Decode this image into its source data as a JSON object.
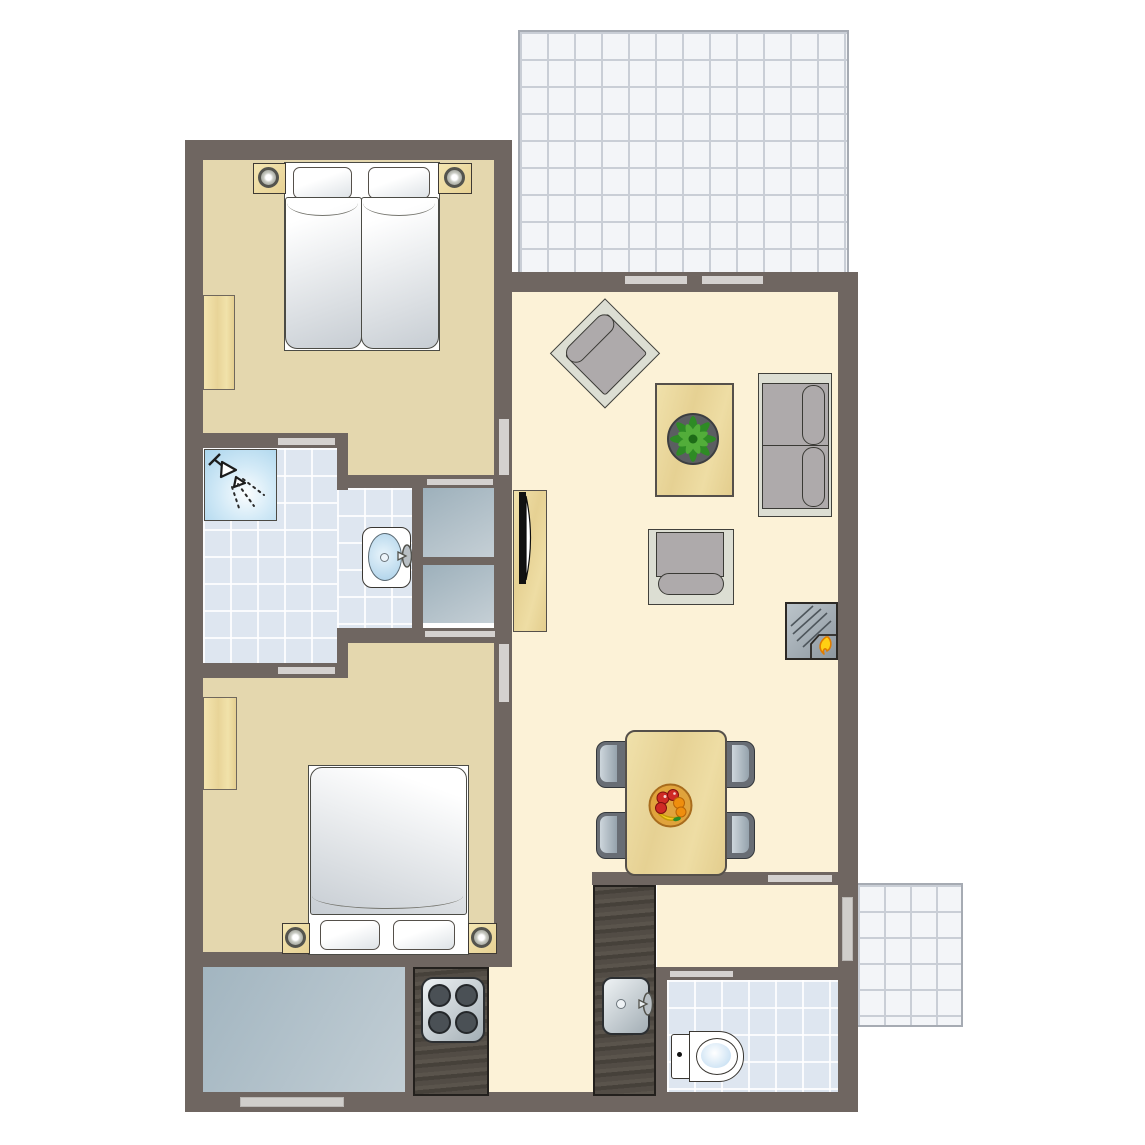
{
  "title": "Apartment floor plan",
  "canvas": {
    "width": 1145,
    "height": 1145
  },
  "palette": {
    "outside": "#ffffff",
    "wall": "#6f6661",
    "door": "#d4d1cf",
    "window": "#d0cecb",
    "bedroom_floor": "#e4d7ae",
    "living_floor": "#fcf2d7",
    "bath_tile": "#dee6f0",
    "terrace_tile": "#f3f5f8",
    "terrace_line": "#c9ced6",
    "terrace_border": "#a6abb3",
    "wood_edge": "#55504a",
    "counter_edge": "#23201d",
    "outline": "#4b4b45",
    "matt_hi": "#ffffff",
    "matt_lo": "#c7cdd3",
    "sofa_base": "#dcded3",
    "cushion": "#aeaaab",
    "chair_dark": "#686d74",
    "chair_edge": "#33373b",
    "seat_hi": "#cdd6dc",
    "seat_lo": "#95a2ac",
    "closet_hi": "#c6d0d6",
    "closet_lo": "#9db0bb",
    "storage_hi": "#c2ced5",
    "storage_lo": "#a2b5c0",
    "shower_hi": "#fbfdfe",
    "shower_lo": "#a9d4ec",
    "basin_hi": "#e8f4fb",
    "basin_lo": "#a8cfe8",
    "appl_hi": "#eef2f4",
    "appl_lo": "#a3aeb5",
    "burner": "#4a5055",
    "pot": "#5b5e61",
    "leaf_dark": "#2e8b25",
    "leaf_light": "#52ad3a",
    "flame": "#ffd013",
    "flame_edge": "#e07c00",
    "bowl": "#e0a33c",
    "fruit_red": "#cf2a25",
    "fruit_orange": "#ef8e0d",
    "fruit_banana": "#f5cf1e",
    "white": "#ffffff",
    "black": "#111111"
  },
  "rooms": [
    {
      "id": "bedroom-1",
      "name": "Bedroom 1 (twin beds)"
    },
    {
      "id": "bedroom-2",
      "name": "Bedroom 2 (double bed)"
    },
    {
      "id": "bathroom",
      "name": "Bathroom with shower and washbasin"
    },
    {
      "id": "living-room",
      "name": "Living room"
    },
    {
      "id": "kitchen",
      "name": "Kitchen"
    },
    {
      "id": "hallway",
      "name": "Hallway"
    },
    {
      "id": "toilet-room",
      "name": "Toilet room"
    },
    {
      "id": "storage-room",
      "name": "Storage room"
    },
    {
      "id": "terrace-top",
      "name": "Terrace (tiled)"
    },
    {
      "id": "terrace-bottom",
      "name": "Terrace (tiled, small)"
    },
    {
      "id": "closet-1",
      "name": "Closet niche bedroom 1"
    },
    {
      "id": "closet-2",
      "name": "Closet niche bedroom 2"
    }
  ],
  "furniture": [
    {
      "id": "twin-beds",
      "name": "Two single beds pushed together",
      "count": 1
    },
    {
      "id": "double-bed",
      "name": "Double bed",
      "count": 1
    },
    {
      "id": "nightstand-with-lamp",
      "name": "Nightstand with lamp",
      "count": 4
    },
    {
      "id": "wardrobe",
      "name": "Wardrobe",
      "count": 2
    },
    {
      "id": "shower",
      "name": "Corner shower",
      "count": 1
    },
    {
      "id": "washbasin",
      "name": "Washbasin",
      "count": 1
    },
    {
      "id": "toilet",
      "name": "Toilet",
      "count": 1
    },
    {
      "id": "kitchen-sink",
      "name": "Kitchen sink",
      "count": 1
    },
    {
      "id": "stove",
      "name": "Four-burner stove",
      "count": 1
    },
    {
      "id": "tv-cabinet",
      "name": "TV cabinet with TV",
      "count": 1
    },
    {
      "id": "sofa",
      "name": "Two-seat sofa",
      "count": 1
    },
    {
      "id": "armchair",
      "name": "Armchair",
      "count": 2
    },
    {
      "id": "coffee-table",
      "name": "Coffee table",
      "count": 1
    },
    {
      "id": "potted-plant",
      "name": "Potted plant",
      "count": 1
    },
    {
      "id": "fireplace",
      "name": "Fireplace / stove unit",
      "count": 1
    },
    {
      "id": "dining-table",
      "name": "Dining table",
      "count": 1
    },
    {
      "id": "dining-chair",
      "name": "Dining chair",
      "count": 4
    },
    {
      "id": "fruit-bowl",
      "name": "Fruit bowl",
      "count": 1
    }
  ],
  "openings": [
    {
      "id": "sliding-terrace-door",
      "name": "Sliding door to terrace (two panels)"
    },
    {
      "id": "door-bedroom-1",
      "name": "Door living room to bedroom 1"
    },
    {
      "id": "door-bedroom-2",
      "name": "Door living room to bedroom 2"
    },
    {
      "id": "door-bathroom-bedroom-1",
      "name": "Door bedroom 1 to bathroom"
    },
    {
      "id": "door-bathroom-bedroom-2",
      "name": "Door bedroom 2 to bathroom"
    },
    {
      "id": "closet-1-opening",
      "name": "Closet opening bedroom 1"
    },
    {
      "id": "closet-2-opening",
      "name": "Closet opening bedroom 2"
    },
    {
      "id": "door-hallway",
      "name": "Door living room to hallway"
    },
    {
      "id": "door-toilet",
      "name": "Door hallway to toilet"
    },
    {
      "id": "window-right",
      "name": "Window right wall"
    },
    {
      "id": "window-bottom",
      "name": "Window bottom wall"
    }
  ]
}
